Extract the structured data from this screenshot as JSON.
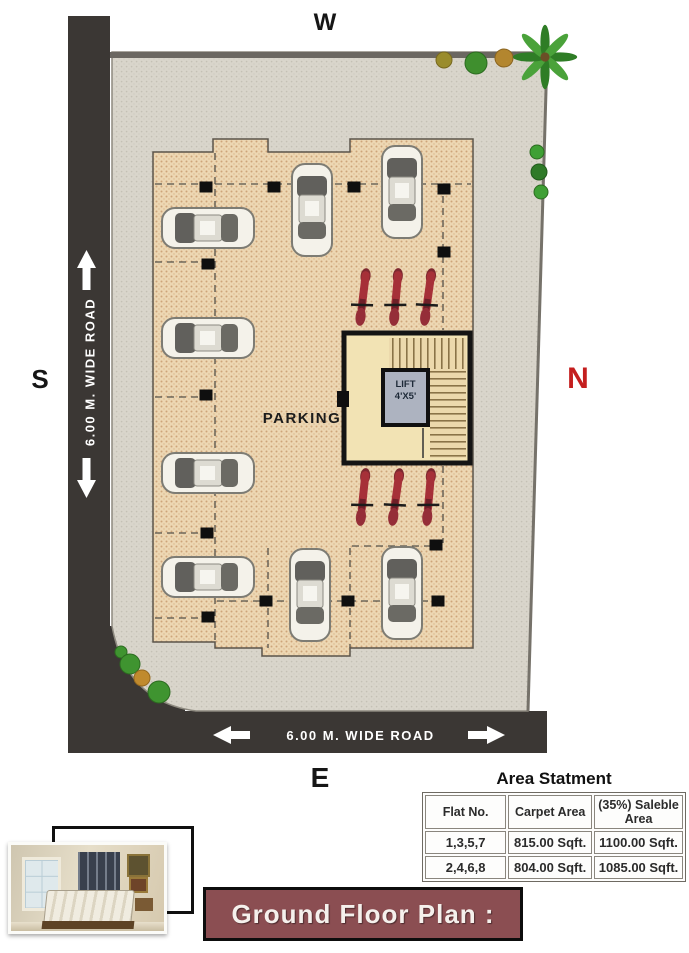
{
  "compass": {
    "west": "W",
    "south": "S",
    "north": "N",
    "east": "E"
  },
  "roads": {
    "left_label": "6.00 M. WIDE ROAD",
    "bottom_label": "6.00 M. WIDE  ROAD"
  },
  "plan": {
    "parking_label": "PARKING",
    "lift_line1": "LIFT",
    "lift_line2": "4'X5'"
  },
  "area_statement": {
    "title": "Area Statment",
    "columns": [
      "Flat No.",
      "Carpet Area",
      "(35%) Saleble Area"
    ],
    "rows": [
      [
        "1,3,5,7",
        "815.00 Sqft.",
        "1100.00 Sqft."
      ],
      [
        "2,4,6,8",
        "804.00 Sqft.",
        "1085.00 Sqft."
      ]
    ]
  },
  "footer": {
    "title": "Ground Floor Plan :"
  },
  "colors": {
    "road": "#3b3734",
    "plot_fill": "#d9d5cb",
    "building_fill": "#edd7b3",
    "stair_block_fill": "#f2e3b4",
    "lift_fill": "#adb3c0",
    "footer_bg": "#8b4e52",
    "north_red": "#c41e1e",
    "bike_red": "#a63038"
  }
}
